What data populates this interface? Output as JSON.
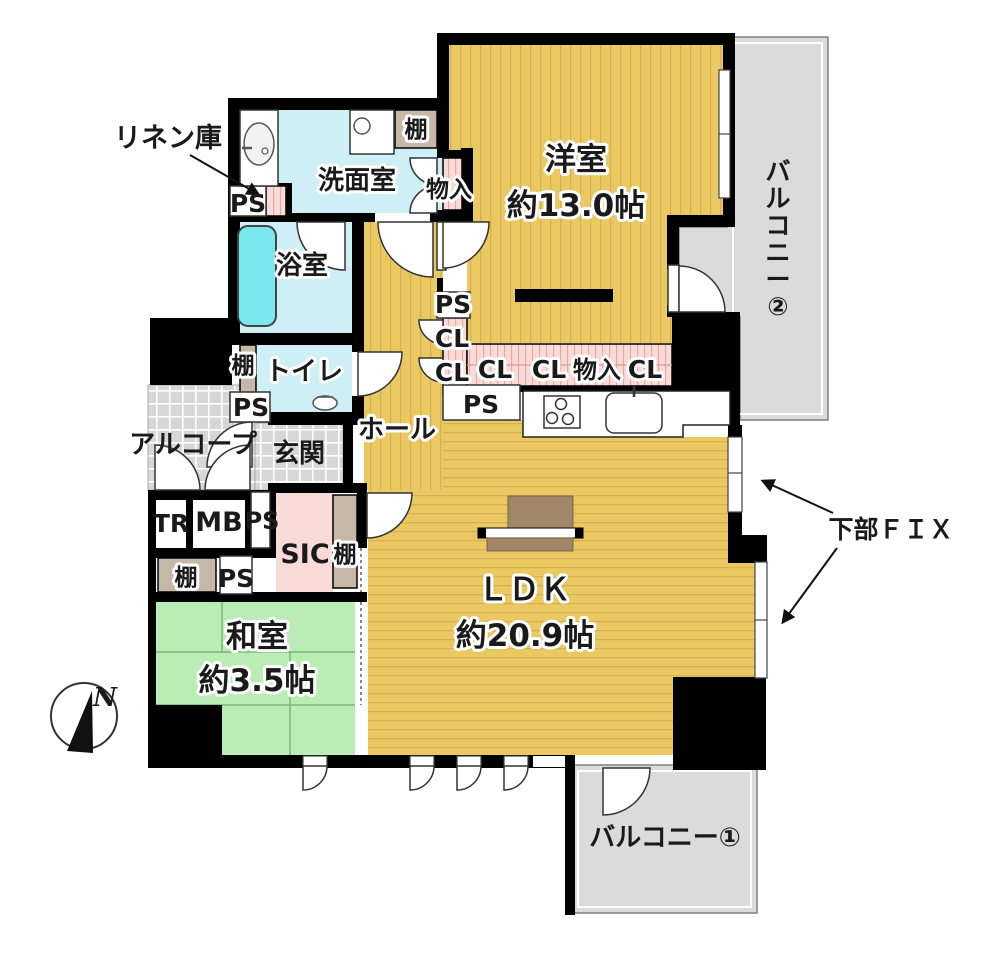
{
  "plan": {
    "rooms": [
      {
        "id": "western-room",
        "name": "洋室",
        "area": "約13.0帖"
      },
      {
        "id": "ldk",
        "name": "ＬＤＫ",
        "area": "約20.9帖"
      },
      {
        "id": "japanese-room",
        "name": "和室",
        "area": "約3.5帖"
      },
      {
        "id": "washroom",
        "name": "洗面室"
      },
      {
        "id": "bathroom",
        "name": "浴室"
      },
      {
        "id": "toilet",
        "name": "トイレ"
      },
      {
        "id": "hall",
        "name": "ホール"
      },
      {
        "id": "entrance",
        "name": "玄関"
      },
      {
        "id": "alcove",
        "name": "アルコープ"
      },
      {
        "id": "sic",
        "name": "SIC"
      },
      {
        "id": "balcony-1",
        "name": "バルコニー①"
      },
      {
        "id": "balcony-2",
        "name": "バルコニー②"
      }
    ],
    "annotations": [
      {
        "id": "linen-note",
        "text": "リネン庫"
      },
      {
        "id": "lower-fix-note",
        "text": "下部ＦＩＸ"
      },
      {
        "id": "compass-north",
        "text": "N"
      }
    ],
    "colors": {
      "wall": "#000000",
      "tan_room": "#eac963",
      "tan_stripe": "#d8b052",
      "green_room": "#b9edb4",
      "green_line": "#76b87a",
      "cyan_room": "#cdeff5",
      "tub": "#79e7ee",
      "pink_closet": "#f8dbd6",
      "pink_hatch": "#e8a7a2",
      "shelf_beige": "#c5b8a8",
      "balcony_gray": "#dbdbdb",
      "checker_gray": "#d7d7d7",
      "furniture_brown": "#a2866a"
    },
    "labels": [
      {
        "id": "linen-label",
        "text": "リネン庫",
        "x": 168,
        "y": 147,
        "size": 27
      },
      {
        "id": "washroom-label",
        "text": "洗面室",
        "x": 357,
        "y": 189,
        "size": 26,
        "halo": true
      },
      {
        "id": "shelf-top-label",
        "text": "棚",
        "x": 416,
        "y": 137,
        "size": 23,
        "halo": true
      },
      {
        "id": "storage-1-label",
        "text": "物入",
        "x": 449,
        "y": 197,
        "size": 23,
        "halo": true
      },
      {
        "id": "ps-1-label",
        "text": "PS",
        "x": 248,
        "y": 212,
        "size": 25
      },
      {
        "id": "bath-label",
        "text": "浴室",
        "x": 302,
        "y": 274,
        "size": 26,
        "halo": true
      },
      {
        "id": "shelf-toilet-label",
        "text": "棚",
        "x": 243,
        "y": 373,
        "size": 23,
        "halo": true
      },
      {
        "id": "toilet-label",
        "text": "トイレ",
        "x": 304,
        "y": 380,
        "size": 26,
        "halo": true
      },
      {
        "id": "ps-2-label",
        "text": "PS",
        "x": 251,
        "y": 416,
        "size": 25
      },
      {
        "id": "alcove-label",
        "text": "アルコープ",
        "x": 193,
        "y": 453,
        "size": 26
      },
      {
        "id": "entrance-label",
        "text": "玄関",
        "x": 299,
        "y": 462,
        "size": 26
      },
      {
        "id": "hall-label",
        "text": "ホール",
        "x": 397,
        "y": 438,
        "size": 26,
        "halo": true
      },
      {
        "id": "ps-3-label",
        "text": "PS",
        "x": 453,
        "y": 313,
        "size": 25,
        "halo": true
      },
      {
        "id": "cl-1-label",
        "text": "CL",
        "x": 452,
        "y": 347,
        "size": 25,
        "halo": true
      },
      {
        "id": "cl-2-label",
        "text": "CL",
        "x": 452,
        "y": 381,
        "size": 25,
        "halo": true
      },
      {
        "id": "cl-3-label",
        "text": "CL",
        "x": 495,
        "y": 378,
        "size": 25,
        "halo": true
      },
      {
        "id": "cl-4-label",
        "text": "CL",
        "x": 549,
        "y": 378,
        "size": 25,
        "halo": true
      },
      {
        "id": "storage-2-label",
        "text": "物入",
        "x": 597,
        "y": 378,
        "size": 24,
        "halo": true
      },
      {
        "id": "cl-5-label",
        "text": "CL",
        "x": 645,
        "y": 378,
        "size": 25,
        "halo": true
      },
      {
        "id": "ps-4-label",
        "text": "PS",
        "x": 481,
        "y": 413,
        "size": 25
      },
      {
        "id": "western-label",
        "text": "洋室",
        "x": 576,
        "y": 170,
        "size": 31,
        "halo": true
      },
      {
        "id": "western-size-label",
        "text": "約13.0帖",
        "x": 576,
        "y": 216,
        "size": 31,
        "halo": true
      },
      {
        "id": "balcony-2-label",
        "text": "バルコニー②",
        "x": 778,
        "y": 180,
        "size": 25,
        "vertical": true
      },
      {
        "id": "tr-label",
        "text": "TR",
        "x": 171,
        "y": 532,
        "size": 25
      },
      {
        "id": "mb-label",
        "text": "MB",
        "x": 219,
        "y": 531,
        "size": 27
      },
      {
        "id": "ps-5-label",
        "text": "PS",
        "x": 262,
        "y": 529,
        "size": 24
      },
      {
        "id": "sic-label",
        "text": "SIC",
        "x": 305,
        "y": 563,
        "size": 27
      },
      {
        "id": "shelf-sic-label",
        "text": "棚",
        "x": 345,
        "y": 562,
        "size": 23,
        "halo": true
      },
      {
        "id": "shelf-washitsu-label",
        "text": "棚",
        "x": 186,
        "y": 585,
        "size": 23,
        "halo": true
      },
      {
        "id": "ps-6-label",
        "text": "PS",
        "x": 236,
        "y": 587,
        "size": 25
      },
      {
        "id": "japanese-label",
        "text": "和室",
        "x": 257,
        "y": 647,
        "size": 31,
        "halo": true
      },
      {
        "id": "japanese-size-label",
        "text": "約3.5帖",
        "x": 257,
        "y": 691,
        "size": 31,
        "halo": true
      },
      {
        "id": "ldk-label",
        "text": "ＬＤＫ",
        "x": 524,
        "y": 600,
        "size": 31,
        "halo": true
      },
      {
        "id": "ldk-size-label",
        "text": "約20.9帖",
        "x": 525,
        "y": 646,
        "size": 31,
        "halo": true
      },
      {
        "id": "balcony-1-label",
        "text": "バルコニー①",
        "x": 665,
        "y": 846,
        "size": 26
      },
      {
        "id": "fix-label",
        "text": "下部ＦＩＸ",
        "x": 891,
        "y": 538,
        "size": 25
      },
      {
        "id": "north-label",
        "text": "N",
        "x": 105,
        "y": 706,
        "size": 26,
        "italic": true
      }
    ]
  }
}
